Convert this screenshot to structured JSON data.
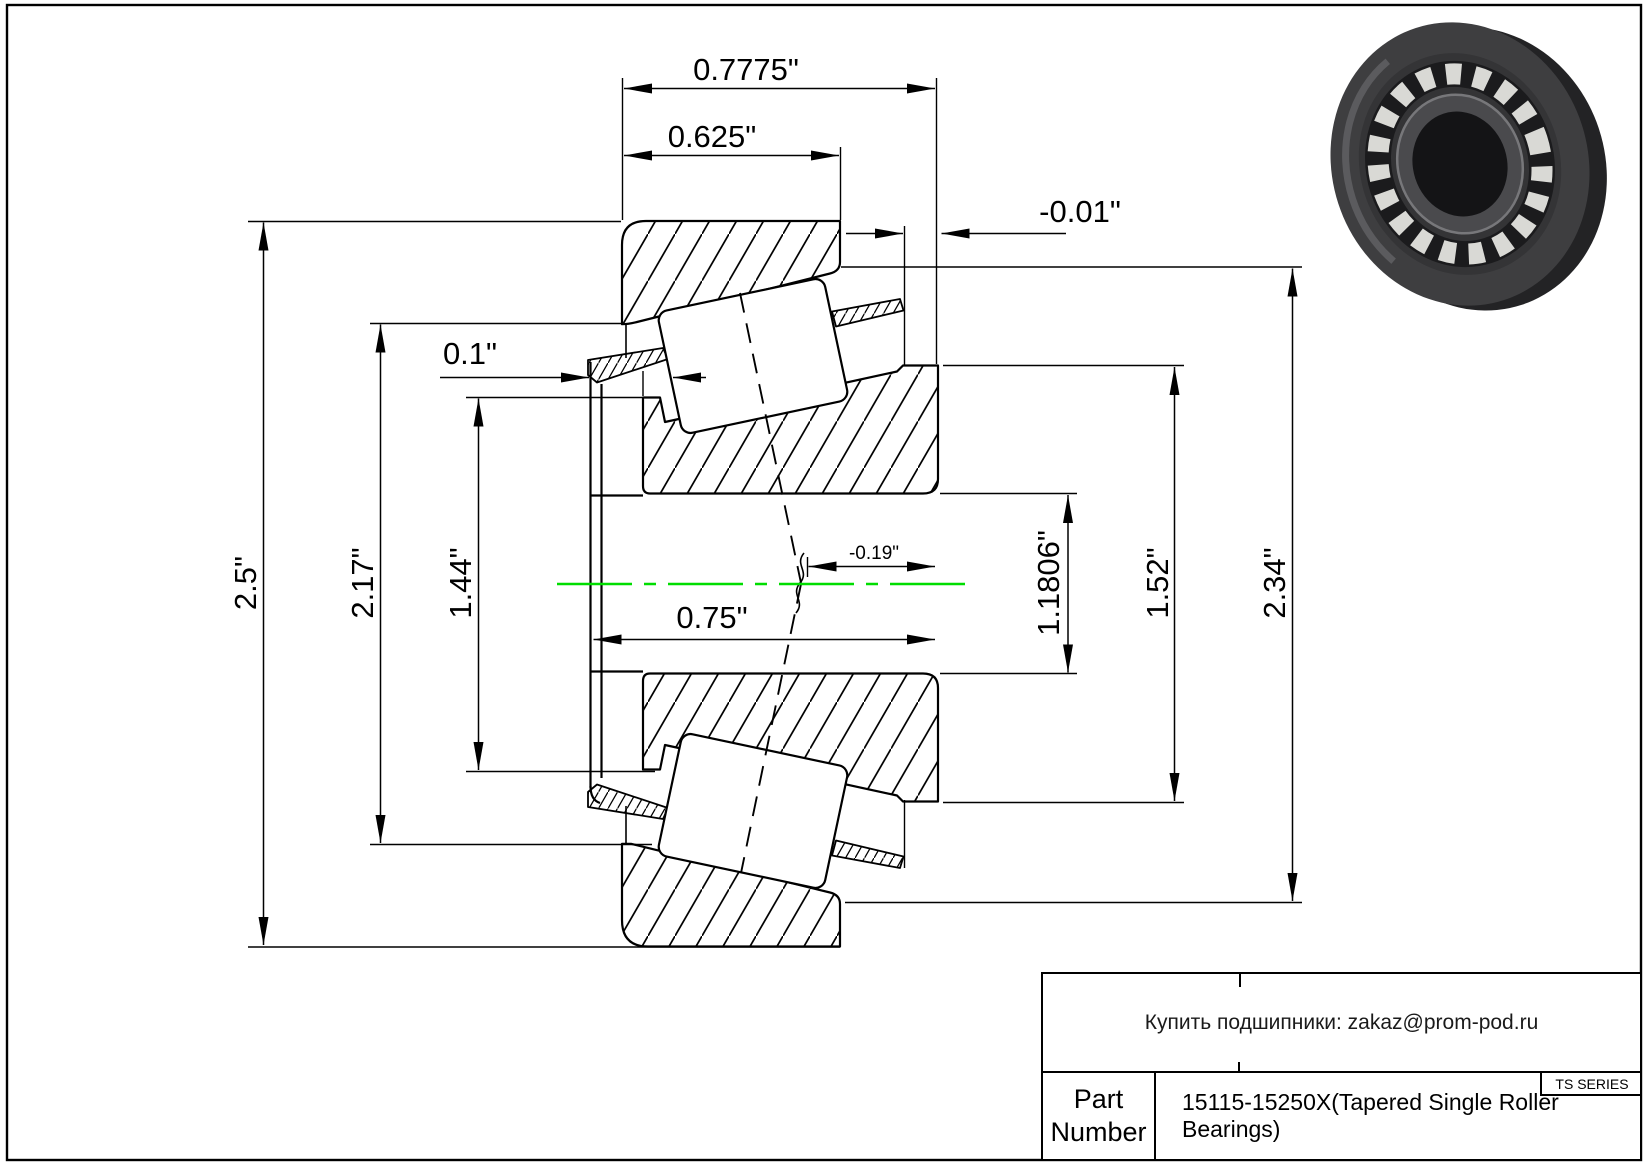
{
  "drawing": {
    "dims": {
      "overall_width": "0.7775\"",
      "cup_width": "0.625\"",
      "stickout": "-0.01\"",
      "front_gap": "0.1\"",
      "cup_od": "2.5\"",
      "race_od": "2.17\"",
      "seal_od": "1.44\"",
      "cone_width": "0.75\"",
      "center_offset": "-0.19\"",
      "bore": "1.1806\"",
      "cone_front_od": "1.52\"",
      "race_id": "2.34\""
    },
    "centerline_color": "#00dd00"
  },
  "title_block": {
    "contact": "Купить подшипники: zakaz@prom-pod.ru",
    "series": "TS SERIES",
    "part_label_line1": "Part",
    "part_label_line2": "Number",
    "part_number": "15115-15250X(Tapered Single Roller Bearings)"
  }
}
